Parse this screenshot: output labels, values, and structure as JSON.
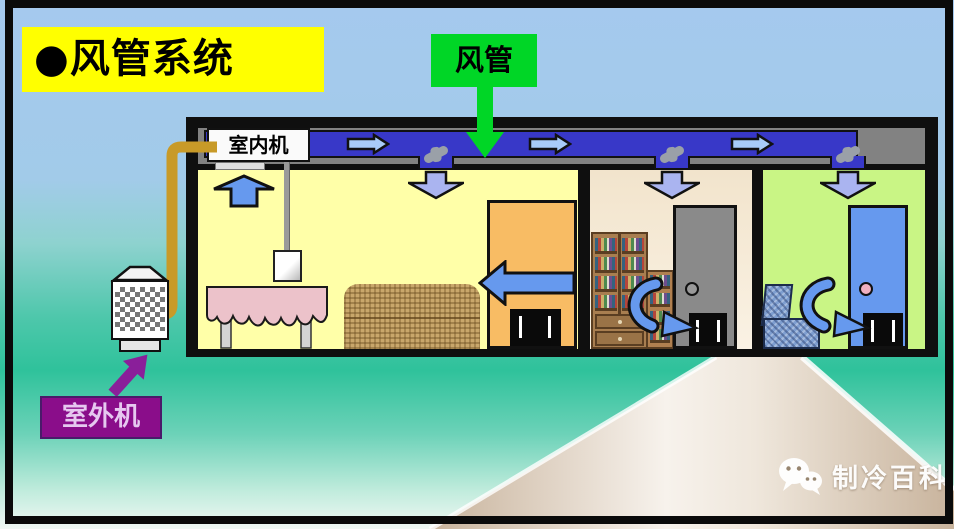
{
  "slide": {
    "title": "●风管系统",
    "callouts": {
      "duct": "风管",
      "indoor_unit": "室内机",
      "outdoor_unit": "室外机"
    },
    "watermark": {
      "icon": "wechat-icon",
      "text": "制冷百科"
    },
    "colors": {
      "background_top": "#a5c9ee",
      "background_teal": "#2fc29b",
      "title_bg": "#ffff00",
      "duct_label_bg": "#00d626",
      "outdoor_label_bg": "#8a0d8a",
      "duct_fill": "#3838c8",
      "ceiling_gray": "#828282",
      "supply_arrow": "#aab4f0",
      "return_arrow": "#6699ee",
      "duct_air_arrow": "#a8ccf8",
      "pipe_orange": "#c89a28",
      "room_left_bg": "#ffffa8",
      "room_middle_bg": "#f2e4cc",
      "room_right_bg": "#c9f585"
    }
  }
}
